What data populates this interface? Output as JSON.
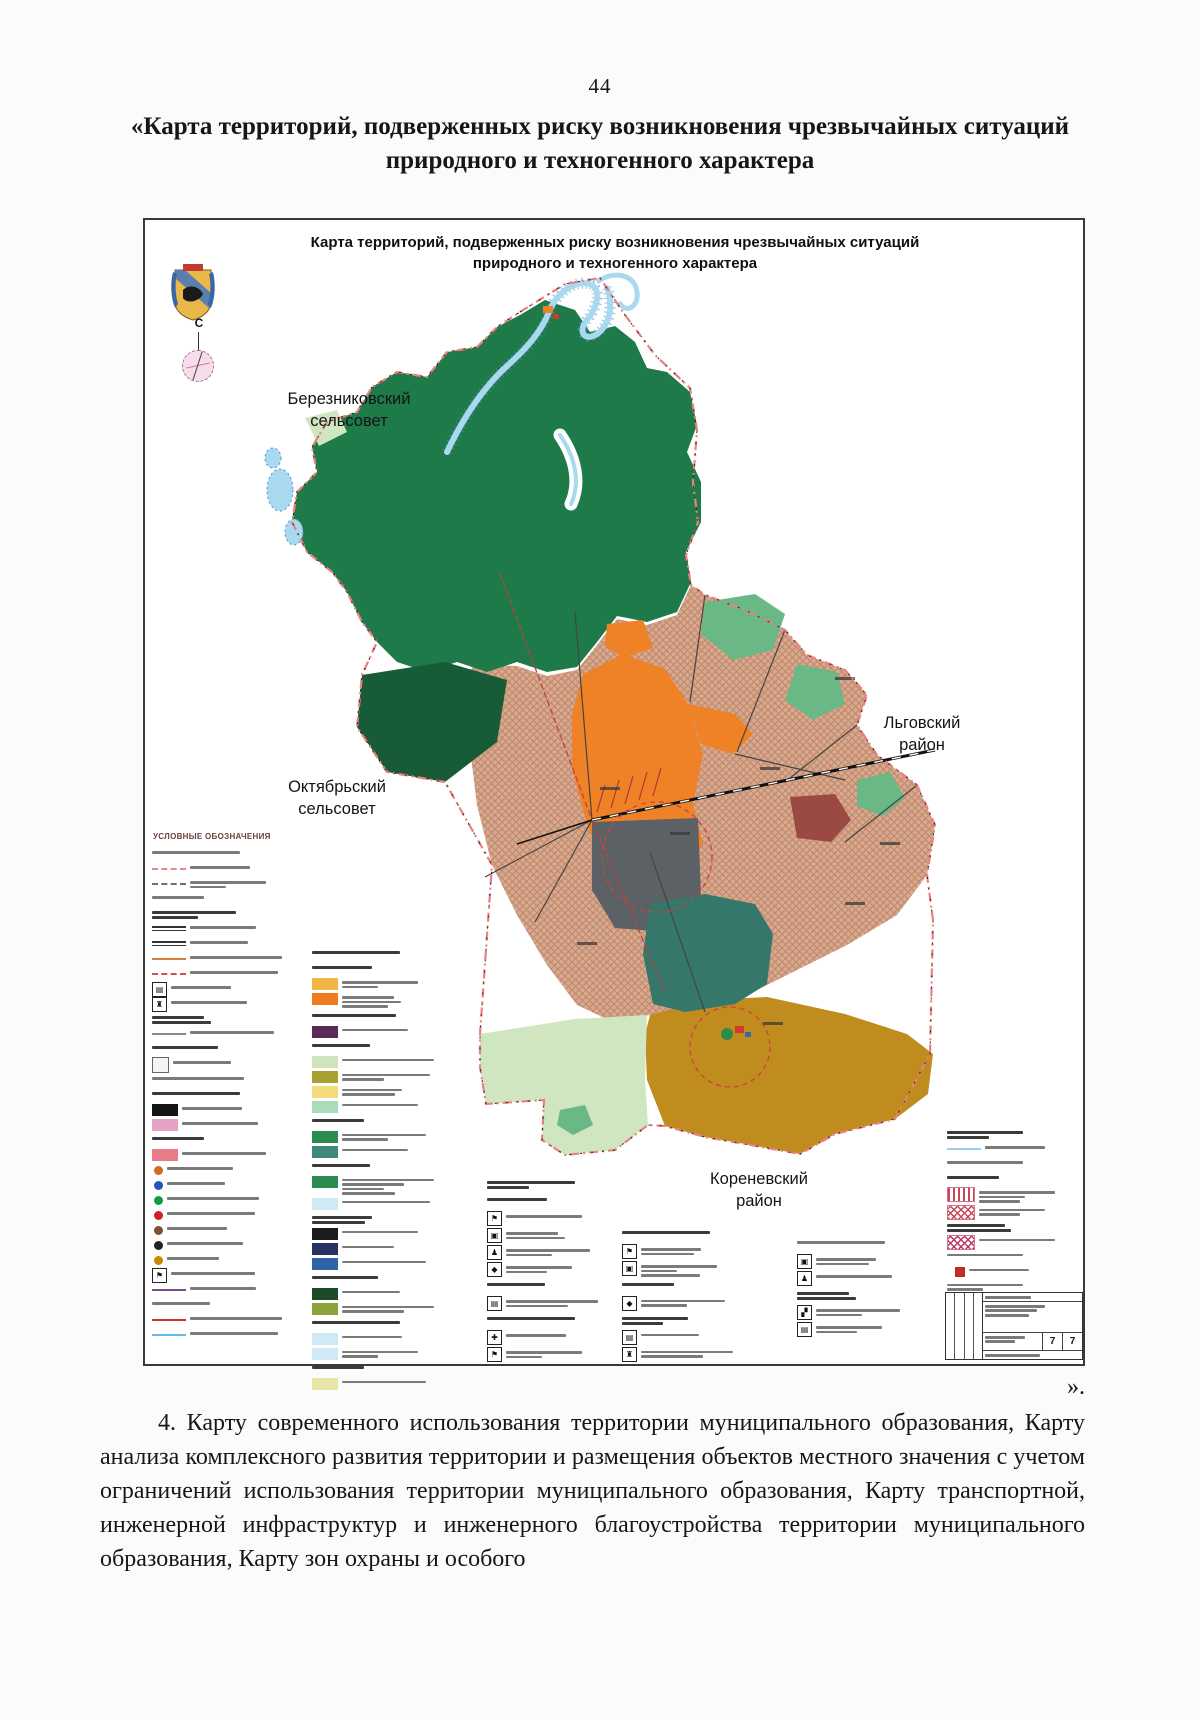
{
  "page": {
    "number": "44",
    "heading": "«Карта территорий, подверженных риску возникновения чрезвычайных ситуаций природного и техногенного характера",
    "closing_quote": "».",
    "paragraph": "4. Карту современного использования территории муниципального образования, Карту анализа комплексного развития территории и размещения объектов местного значения с учетом ограничений использования территории муниципального образования, Карту транспортной, инженерной инфраструктур и инженерного благоустройства территории муниципального образования, Карту зон охраны и особого"
  },
  "map": {
    "title_line1": "Карта территорий, подверженных риску возникновения чрезвычайных ситуаций",
    "title_line2": "природного и техногенного характера",
    "north_label": "С",
    "legend_title": "УСЛОВНЫЕ ОБОЗНАЧЕНИЯ",
    "labels": {
      "berezniki_1": "Березниковский",
      "berezniki_2": "сельсовет",
      "oktyabr_1": "Октябрьский",
      "oktyabr_2": "сельсовет",
      "lgov_1": "Льговский",
      "lgov_2": "район",
      "korenevo_1": "Кореневский",
      "korenevo_2": "район"
    },
    "stamp": {
      "sheet": "7",
      "total_sheets": "7"
    },
    "colors": {
      "forest": "#1f7a4a",
      "forest_dark": "#175c36",
      "farmland_base": "#d8a98c",
      "farmland_hatch": "#b97f66",
      "meadow_green": "#69b886",
      "urban_orange": "#ef8226",
      "industrial_gray": "#5b6165",
      "teal_zone": "#35786b",
      "agro_mustard": "#c08c1e",
      "pasture_lightgreen": "#cfe6c0",
      "water": "#a9d9ef",
      "water_edge": "#5588cc",
      "boundary_pink": "#ec8080",
      "risk_red": "#d04040",
      "dark_red_zone": "#9a4a42"
    },
    "legend_columns": [
      {
        "x": 7,
        "y": 627,
        "w": 150,
        "rh": 15,
        "rows": [
          {
            "k": "t"
          },
          {
            "k": "ln",
            "c": "#e08a8a",
            "st": "dashed"
          },
          {
            "k": "ln",
            "c": "#707070",
            "st": "dashed",
            "b": 2
          },
          {
            "k": "t"
          },
          {
            "k": "h",
            "b": 2
          },
          {
            "k": "dln",
            "c": "#333333"
          },
          {
            "k": "dln",
            "c": "#333333"
          },
          {
            "k": "ln",
            "c": "#d2813c",
            "st": "solid"
          },
          {
            "k": "ln",
            "c": "#d05050",
            "st": "dashed"
          },
          {
            "k": "ic"
          },
          {
            "k": "ic"
          },
          {
            "k": "h",
            "b": 2
          },
          {
            "k": "ln",
            "c": "#888888",
            "st": "solid"
          },
          {
            "k": "h"
          },
          {
            "k": "icO"
          },
          {
            "k": "t"
          },
          {
            "k": "h"
          },
          {
            "k": "sw",
            "c": "#141414"
          },
          {
            "k": "sw",
            "c": "#e4a2c6"
          },
          {
            "k": "h"
          },
          {
            "k": "sw",
            "c": "#e87c86"
          },
          {
            "k": "cir",
            "c": "#d2691e"
          },
          {
            "k": "cir",
            "c": "#2255bb"
          },
          {
            "k": "cir",
            "c": "#119944"
          },
          {
            "k": "cir",
            "c": "#cc2222"
          },
          {
            "k": "cir",
            "c": "#7a5230"
          },
          {
            "k": "cir",
            "c": "#222222"
          },
          {
            "k": "cir",
            "c": "#cc8800"
          },
          {
            "k": "ic"
          },
          {
            "k": "ln",
            "c": "#7a4a8a",
            "st": "solid"
          },
          {
            "k": "t"
          },
          {
            "k": "ln",
            "c": "#cc3333",
            "st": "solid"
          },
          {
            "k": "ln",
            "c": "#66bbee",
            "st": "solid"
          }
        ]
      },
      {
        "x": 167,
        "y": 727,
        "w": 168,
        "rh": 15,
        "rows": [
          {
            "k": "h"
          },
          {
            "k": "h"
          },
          {
            "k": "sw",
            "c": "#f0b545",
            "b": 2
          },
          {
            "k": "sw",
            "c": "#ef7b1e",
            "b": 3
          },
          {
            "k": "h"
          },
          {
            "k": "sw",
            "c": "#5c2a56"
          },
          {
            "k": "h"
          },
          {
            "k": "sw",
            "c": "#cfe3bd"
          },
          {
            "k": "sw",
            "c": "#a8a030",
            "b": 2
          },
          {
            "k": "sw",
            "c": "#f2dc7a",
            "b": 2
          },
          {
            "k": "sw",
            "c": "#a9dcb8"
          },
          {
            "k": "h"
          },
          {
            "k": "sw",
            "c": "#2a8c4e",
            "b": 2
          },
          {
            "k": "sw",
            "c": "#40887c"
          },
          {
            "k": "h"
          },
          {
            "k": "sw",
            "c": "#2a8c4e",
            "b": 4
          },
          {
            "k": "sw",
            "c": "#cfe9f5"
          },
          {
            "k": "h",
            "b": 2
          },
          {
            "k": "sw",
            "c": "#1c1c1c"
          },
          {
            "k": "sw",
            "c": "#2a3260"
          },
          {
            "k": "sw",
            "c": "#2f64a8"
          },
          {
            "k": "h"
          },
          {
            "k": "sw",
            "c": "#1c4a26"
          },
          {
            "k": "sw",
            "c": "#8aa23c",
            "b": 2
          },
          {
            "k": "h"
          },
          {
            "k": "sw",
            "c": "#cfeaf5"
          },
          {
            "k": "sw",
            "c": "#cfeaf5",
            "b": 2
          },
          {
            "k": "h"
          },
          {
            "k": "sw",
            "c": "#e6e6a8"
          }
        ]
      },
      {
        "x": 342,
        "y": 957,
        "w": 155,
        "rh": 17,
        "rows": [
          {
            "k": "h",
            "b": 2
          },
          {
            "k": "h"
          },
          {
            "k": "ic"
          },
          {
            "k": "ic",
            "b": 2
          },
          {
            "k": "ic",
            "b": 2
          },
          {
            "k": "ic",
            "b": 2
          },
          {
            "k": "h"
          },
          {
            "k": "ic",
            "b": 2
          },
          {
            "k": "h"
          },
          {
            "k": "ic"
          },
          {
            "k": "ic",
            "b": 2
          }
        ]
      },
      {
        "x": 477,
        "y": 1007,
        "w": 150,
        "rh": 17,
        "rows": [
          {
            "k": "h"
          },
          {
            "k": "ic",
            "b": 2
          },
          {
            "k": "ic",
            "b": 3
          },
          {
            "k": "h"
          },
          {
            "k": "ic",
            "b": 2
          },
          {
            "k": "h",
            "b": 2
          },
          {
            "k": "ic"
          },
          {
            "k": "ic",
            "b": 2
          }
        ]
      },
      {
        "x": 652,
        "y": 1017,
        "w": 150,
        "rh": 17,
        "rows": [
          {
            "k": "t"
          },
          {
            "k": "ic",
            "b": 2
          },
          {
            "k": "ic"
          },
          {
            "k": "h",
            "b": 2
          },
          {
            "k": "ic",
            "b": 2
          },
          {
            "k": "ic",
            "b": 2
          }
        ]
      },
      {
        "x": 802,
        "y": 907,
        "w": 120,
        "rh": 15,
        "rows": [
          {
            "k": "h",
            "b": 2
          },
          {
            "k": "ln",
            "c": "#99ccee",
            "st": "solid"
          },
          {
            "k": "t"
          },
          {
            "k": "h"
          },
          {
            "k": "hz",
            "c": "#cc4455",
            "v": "vert",
            "b": 3
          },
          {
            "k": "hz",
            "c": "#cc4455",
            "v": "cross",
            "b": 2
          },
          {
            "k": "h",
            "b": 2
          },
          {
            "k": "hz",
            "c": "#bb3366",
            "v": "cross"
          },
          {
            "k": "t"
          },
          {
            "k": "rs",
            "c": "#c03020"
          },
          {
            "k": "t",
            "b": 2
          }
        ]
      }
    ]
  }
}
